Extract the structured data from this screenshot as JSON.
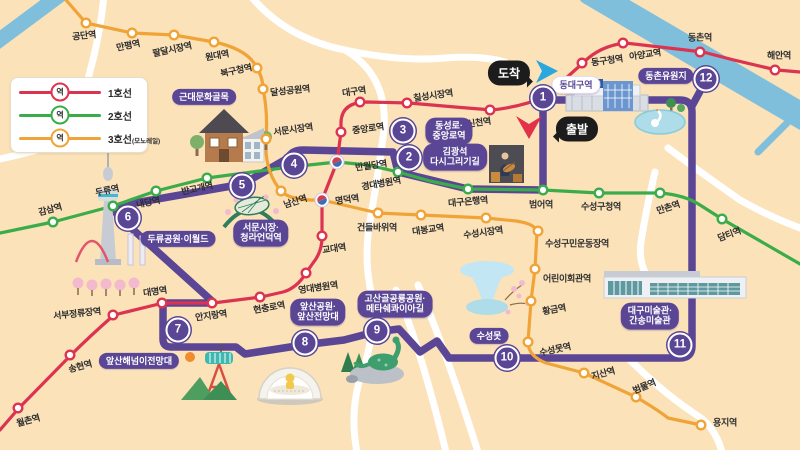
{
  "colors": {
    "bg": "#FBE2B9",
    "line1": "#DC3350",
    "line2": "#3BAC4A",
    "line3": "#F0A437",
    "route": "#5A4695",
    "river": "#7FBFDB",
    "road": "#FFFFFF"
  },
  "legend": {
    "rows": [
      {
        "station_label": "역",
        "line_label": "1호선",
        "suffix": "",
        "line": "line1"
      },
      {
        "station_label": "역",
        "line_label": "2호선",
        "suffix": "",
        "line": "line2"
      },
      {
        "station_label": "역",
        "line_label": "3호선",
        "suffix": "(모노레일)",
        "line": "line3"
      }
    ]
  },
  "annotations": {
    "arrival": "도착",
    "departure": "출발",
    "station_sign": "동대구역"
  },
  "metro_lines": [
    {
      "id": "line1",
      "name": "1호선",
      "stations": [
        {
          "n": "해안역",
          "x": 775,
          "y": 70,
          "lx": 779,
          "ly": 55,
          "r": 0
        },
        {
          "n": "동촌역",
          "x": 700,
          "y": 52,
          "lx": 700,
          "ly": 37,
          "r": 0
        },
        {
          "n": "아양교역",
          "x": 623,
          "y": 43,
          "lx": 645,
          "ly": 54,
          "r": -8
        },
        {
          "n": "동구청역",
          "x": 582,
          "y": 63,
          "lx": 607,
          "ly": 60,
          "r": -8
        },
        {
          "n": "신천역",
          "x": 490,
          "y": 110,
          "lx": 479,
          "ly": 122,
          "r": -8
        },
        {
          "n": "칠성시장역",
          "x": 407,
          "y": 103,
          "lx": 433,
          "ly": 95,
          "r": -8
        },
        {
          "n": "대구역",
          "x": 360,
          "y": 102,
          "lx": 354,
          "ly": 91,
          "r": -8
        },
        {
          "n": "중앙로역",
          "x": 341,
          "y": 132,
          "lx": 368,
          "ly": 128,
          "r": -8
        },
        {
          "n": "반월당역",
          "x": 337,
          "y": 162,
          "lx": 371,
          "ly": 165,
          "r": -8,
          "t": true
        },
        {
          "n": "명덕역",
          "x": 322,
          "y": 200,
          "lx": 347,
          "ly": 199,
          "r": -8,
          "t": true
        },
        {
          "n": "교대역",
          "x": 322,
          "y": 236,
          "lx": 334,
          "ly": 248,
          "r": -8
        },
        {
          "n": "영대병원역",
          "x": 306,
          "y": 273,
          "lx": 318,
          "ly": 287,
          "r": -8
        },
        {
          "n": "현충로역",
          "x": 260,
          "y": 297,
          "lx": 269,
          "ly": 307,
          "r": -10
        },
        {
          "n": "안지랑역",
          "x": 212,
          "y": 303,
          "lx": 211,
          "ly": 315,
          "r": -8
        },
        {
          "n": "대명역",
          "x": 162,
          "y": 303,
          "lx": 155,
          "ly": 291,
          "r": -8
        },
        {
          "n": "서부정류장역",
          "x": 113,
          "y": 315,
          "lx": 77,
          "ly": 313,
          "r": -6
        },
        {
          "n": "송현역",
          "x": 70,
          "y": 355,
          "lx": 80,
          "ly": 366,
          "r": -15
        },
        {
          "n": "월촌역",
          "x": 18,
          "y": 408,
          "lx": 28,
          "ly": 420,
          "r": -15
        }
      ]
    },
    {
      "id": "line2",
      "name": "2호선",
      "stations": [
        {
          "n": "감삼역",
          "x": 53,
          "y": 222,
          "lx": 50,
          "ly": 209,
          "r": -15
        },
        {
          "n": "두류역",
          "x": 113,
          "y": 206,
          "lx": 107,
          "ly": 190,
          "r": -12
        },
        {
          "n": "내당역",
          "x": 156,
          "y": 191,
          "lx": 148,
          "ly": 202,
          "r": -12
        },
        {
          "n": "반고개역",
          "x": 207,
          "y": 178,
          "lx": 197,
          "ly": 188,
          "r": -12
        },
        {
          "n": "경대병원역",
          "x": 398,
          "y": 172,
          "lx": 381,
          "ly": 183,
          "r": -10
        },
        {
          "n": "대구은행역",
          "x": 468,
          "y": 189,
          "lx": 468,
          "ly": 201,
          "r": -5
        },
        {
          "n": "범어역",
          "x": 543,
          "y": 190,
          "lx": 541,
          "ly": 204,
          "r": 0
        },
        {
          "n": "수성구청역",
          "x": 599,
          "y": 193,
          "lx": 601,
          "ly": 206,
          "r": 0
        },
        {
          "n": "만촌역",
          "x": 660,
          "y": 193,
          "lx": 668,
          "ly": 207,
          "r": -18
        },
        {
          "n": "담티역",
          "x": 722,
          "y": 219,
          "lx": 729,
          "ly": 234,
          "r": -20
        }
      ]
    },
    {
      "id": "line3",
      "name": "3호선",
      "stations": [
        {
          "n": "공단역",
          "x": 86,
          "y": 23,
          "lx": 84,
          "ly": 35,
          "r": -6
        },
        {
          "n": "만평역",
          "x": 132,
          "y": 33,
          "lx": 128,
          "ly": 45,
          "r": -12
        },
        {
          "n": "팔달시장역",
          "x": 174,
          "y": 35,
          "lx": 172,
          "ly": 49,
          "r": -12
        },
        {
          "n": "원대역",
          "x": 214,
          "y": 42,
          "lx": 217,
          "ly": 55,
          "r": -10
        },
        {
          "n": "북구청역",
          "x": 257,
          "y": 68,
          "lx": 236,
          "ly": 70,
          "r": -12
        },
        {
          "n": "달성공원역",
          "x": 263,
          "y": 89,
          "lx": 290,
          "ly": 90,
          "r": -6
        },
        {
          "n": "서문시장역",
          "x": 266,
          "y": 139,
          "lx": 293,
          "ly": 129,
          "r": -8
        },
        {
          "n": "남산역",
          "x": 281,
          "y": 191,
          "lx": 295,
          "ly": 201,
          "r": -18
        },
        {
          "n": "건들바위역",
          "x": 378,
          "y": 213,
          "lx": 377,
          "ly": 227,
          "r": 0
        },
        {
          "n": "대봉교역",
          "x": 421,
          "y": 215,
          "lx": 428,
          "ly": 229,
          "r": -8
        },
        {
          "n": "수성시장역",
          "x": 486,
          "y": 218,
          "lx": 483,
          "ly": 232,
          "r": -8
        },
        {
          "n": "수성구민운동장역",
          "x": 538,
          "y": 231,
          "lx": 577,
          "ly": 243,
          "r": 0
        },
        {
          "n": "어린이회관역",
          "x": 535,
          "y": 269,
          "lx": 567,
          "ly": 278,
          "r": 0
        },
        {
          "n": "황금역",
          "x": 531,
          "y": 301,
          "lx": 554,
          "ly": 309,
          "r": -10
        },
        {
          "n": "수성못역",
          "x": 528,
          "y": 342,
          "lx": 555,
          "ly": 349,
          "r": -12
        },
        {
          "n": "지산역",
          "x": 584,
          "y": 373,
          "lx": 603,
          "ly": 373,
          "r": -15
        },
        {
          "n": "범물역",
          "x": 636,
          "y": 397,
          "lx": 644,
          "ly": 386,
          "r": -22
        },
        {
          "n": "용지역",
          "x": 701,
          "y": 425,
          "lx": 725,
          "ly": 422,
          "r": 0
        }
      ]
    }
  ],
  "tour": {
    "stops": [
      {
        "num": "1",
        "x": 543,
        "y": 98
      },
      {
        "num": "2",
        "x": 409,
        "y": 158
      },
      {
        "num": "3",
        "x": 403,
        "y": 131
      },
      {
        "num": "4",
        "x": 294,
        "y": 165
      },
      {
        "num": "5",
        "x": 242,
        "y": 186
      },
      {
        "num": "6",
        "x": 128,
        "y": 218
      },
      {
        "num": "7",
        "x": 178,
        "y": 330
      },
      {
        "num": "8",
        "x": 305,
        "y": 343
      },
      {
        "num": "9",
        "x": 377,
        "y": 331
      },
      {
        "num": "10",
        "x": 507,
        "y": 358
      },
      {
        "num": "11",
        "x": 680,
        "y": 345
      },
      {
        "num": "12",
        "x": 706,
        "y": 79
      }
    ],
    "badges": [
      {
        "lines": [
          "동대구역"
        ],
        "x": 576,
        "y": 85,
        "light": true
      },
      {
        "lines": [
          "김광석",
          "다시그리기길"
        ],
        "x": 455,
        "y": 157
      },
      {
        "lines": [
          "동성로·",
          "중앙로역"
        ],
        "x": 449,
        "y": 131
      },
      {
        "lines": [
          "근대문화골목"
        ],
        "x": 204,
        "y": 97
      },
      {
        "lines": [
          "서문시장·",
          "청라언덕역"
        ],
        "x": 261,
        "y": 233
      },
      {
        "lines": [
          "두류공원·이월드"
        ],
        "x": 178,
        "y": 239
      },
      {
        "lines": [
          "앞산해넘이전망대"
        ],
        "x": 139,
        "y": 361
      },
      {
        "lines": [
          "앞산공원·",
          "앞산전망대"
        ],
        "x": 318,
        "y": 312
      },
      {
        "lines": [
          "고산골공룡공원·",
          "메타쉐콰이아길"
        ],
        "x": 395,
        "y": 304
      },
      {
        "lines": [
          "수성못"
        ],
        "x": 489,
        "y": 336
      },
      {
        "lines": [
          "대구미술관·",
          "간송미술관"
        ],
        "x": 650,
        "y": 316
      },
      {
        "lines": [
          "동촌유원지"
        ],
        "x": 666,
        "y": 76
      }
    ]
  },
  "geometry": {
    "roads": [
      "M250 -5 Q285 38 345 50 Q400 62 445 58 Q480 55 505 62",
      "M345 50 Q388 75 384 130 Q378 175 371 215 Q363 255 371 292 Q378 330 359 382 Q350 416 357 452",
      "M396 290 Q420 345 446 452",
      "M418 285 Q445 348 478 452",
      "M628 358 Q662 392 695 414 Q715 426 722 452",
      "M655 172 Q646 210 641 242 Q638 262 648 278",
      "M668 148 Q700 172 740 200 Q768 216 800 228",
      "M104 -5 Q98 60 68 140 Q35 152 -5 160"
    ],
    "rivers": [
      {
        "d": "M590 -8 L812 122",
        "w": 26
      },
      {
        "d": "M-6 44 L64 -8",
        "w": 15
      },
      {
        "d": "M758 152 L802 108",
        "w": 7
      }
    ],
    "route": {
      "d": "M543 100 L543 190 L468 189 L398 172 L393 152 L303 150 Q292 150 288 158 L243 184 L123 205 Q111 208 119 217 L212 301 L212 303 L167 303 Q163 303 163 307 L163 339 Q163 347 171 347 L236 347 L245 354 L303 345 L344 340 L375 332 L399 329 L420 352 L437 341 L449 358 L680 358 Q692 358 692 346 L692 112 Q692 100 680 100 L543 100",
      "spur": "M692 106 L704 84",
      "w": 7.5
    },
    "lines": {
      "line1": "M800 72 L777 70 Q740 62 703 52 L625 43 Q600 46 584 62 L545 97 Q520 107 492 110 L455 107 L409 103 L367 102 Q342 102 341 122 L341 132 L337 162 L322 200 L322 237 Q322 252 313 263 L306 273 Q297 288 283 292 L261 297 L213 303 L163 303 L114 315 Q90 336 71 355 L19 408 L0 430",
      "line2": "M0 233 L53 222 L113 206 L156 191 L207 178 L290 167 L337 162 L368 165 L398 172 L430 181 L468 189 L543 190 L599 193 L660 193 Q685 195 700 205 L722 219 L800 264",
      "line3": "M66 0 L86 23 L132 33 L174 35 L214 42 Q248 49 257 68 Q263 78 263 89 Q268 112 266 139 Q264 172 282 192 Q292 201 322 200 L378 213 L421 215 L486 218 L516 221 Q536 224 537 232 L535 269 L531 301 L528 342 Q528 356 546 363 L584 373 L636 397 Q658 410 668 418 L701 425"
    }
  }
}
